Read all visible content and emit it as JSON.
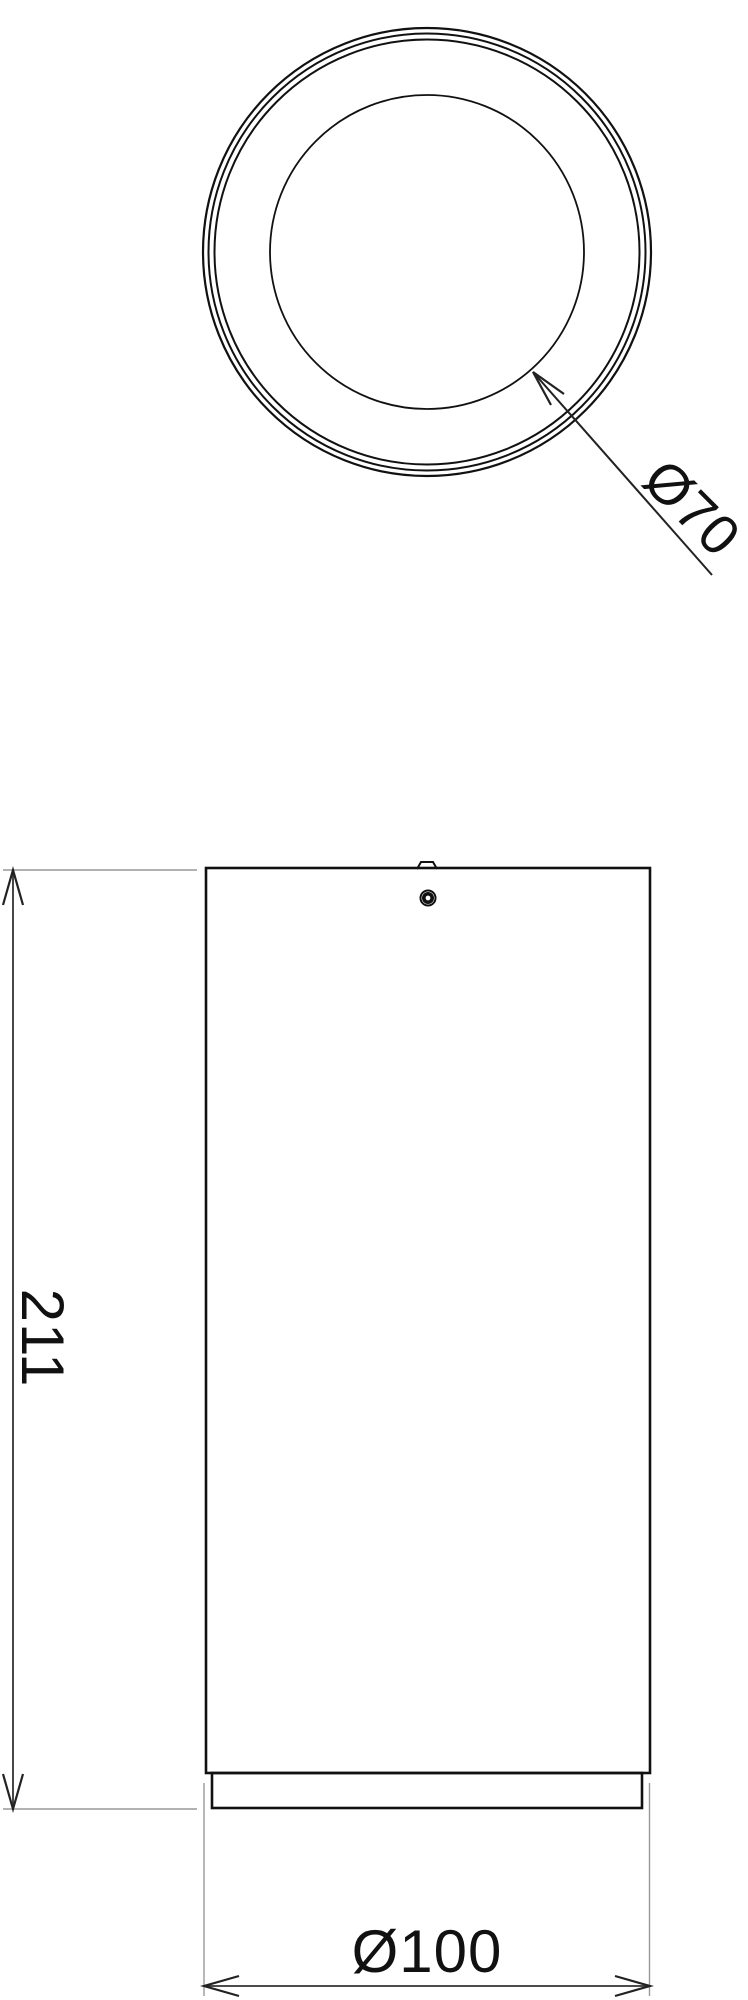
{
  "drawing": {
    "kind": "technical dimension drawing, two orthographic views of a cylindrical luminaire",
    "background_color": "#ffffff",
    "object_line_color": "#111111",
    "dimension_line_color": "#333333",
    "extension_line_color": "#999999",
    "text_color": "#111111"
  },
  "labels": {
    "inner_diameter": "Ø70",
    "overall_height": "211",
    "outer_diameter": "Ø100"
  },
  "dimensions": [
    {
      "label": "Ø70",
      "value": 70,
      "symbol": "Ø",
      "style": "leader",
      "applies_to": "inner circle, top view"
    },
    {
      "label": "211",
      "value": 211,
      "symbol": "",
      "style": "linear-vertical",
      "applies_to": "overall height, front view"
    },
    {
      "label": "Ø100",
      "value": 100,
      "symbol": "Ø",
      "style": "linear-horizontal",
      "applies_to": "outer diameter / body width, front view"
    }
  ]
}
